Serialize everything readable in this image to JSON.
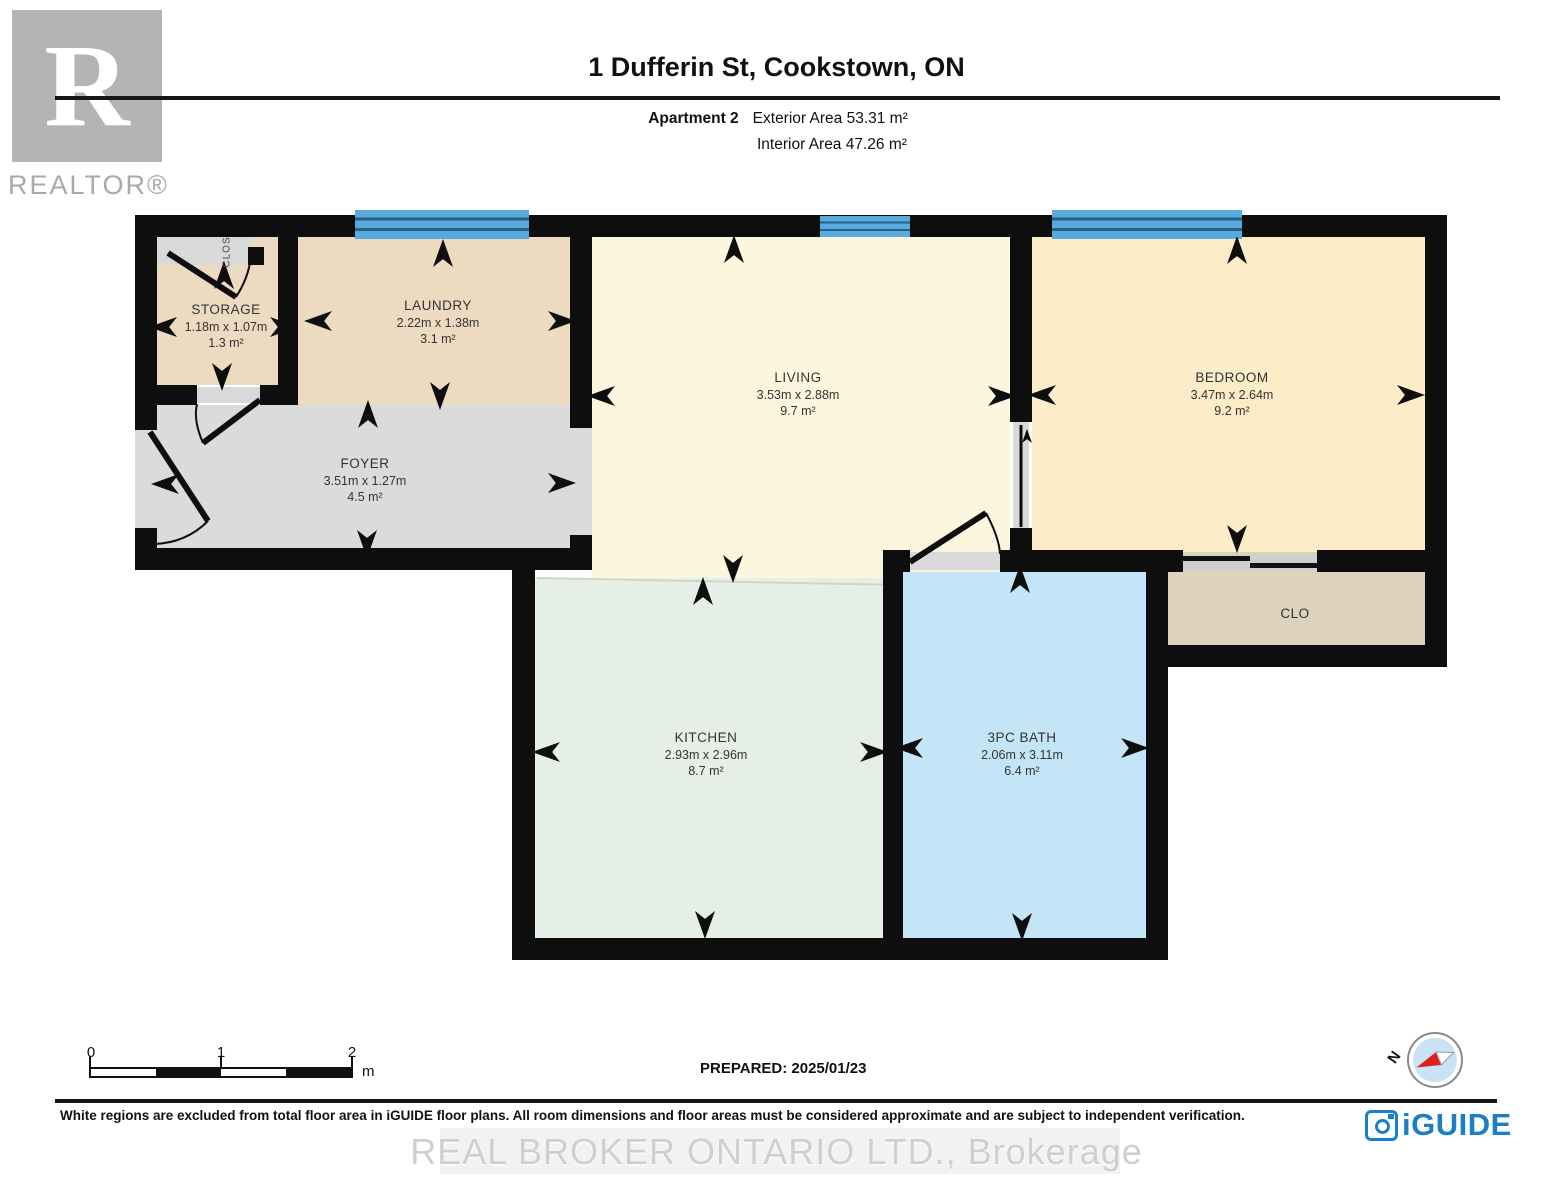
{
  "header": {
    "title": "1 Dufferin St, Cookstown, ON",
    "apartment": "Apartment 2",
    "exterior": "Exterior Area 53.31 m²",
    "interior": "Interior Area 47.26 m²"
  },
  "branding": {
    "realtor_letter": "R",
    "realtor_word": "REALTOR®",
    "iguide": "iGUIDE",
    "compass_north": "N"
  },
  "rooms": [
    {
      "name": "STORAGE",
      "dim": "1.18m x 1.07m",
      "area": "1.3 m²"
    },
    {
      "name": "LAUNDRY",
      "dim": "2.22m x 1.38m",
      "area": "3.1 m²"
    },
    {
      "name": "FOYER",
      "dim": "3.51m x 1.27m",
      "area": "4.5 m²"
    },
    {
      "name": "LIVING",
      "dim": "3.53m x 2.88m",
      "area": "9.7 m²"
    },
    {
      "name": "BEDROOM",
      "dim": "3.47m x 2.64m",
      "area": "9.2 m²"
    },
    {
      "name": "KITCHEN",
      "dim": "2.93m x 2.96m",
      "area": "8.7 m²"
    },
    {
      "name": "3PC BATH",
      "dim": "2.06m x 3.11m",
      "area": "6.4 m²"
    }
  ],
  "closets": {
    "small": "CLOS",
    "bedroom": "CLO"
  },
  "footer": {
    "scale_ticks": [
      "0",
      "1",
      "2"
    ],
    "scale_unit": "m",
    "prepared": "PREPARED: 2025/01/23",
    "disclaimer": "White regions are excluded from total floor area in iGUIDE floor plans. All room dimensions and floor areas must be considered approximate and are subject to independent verification.",
    "watermark": "REAL BROKER ONTARIO LTD., Brokerage"
  },
  "colors": {
    "wall": "#0e0e0e",
    "window_blue": "#57aadb",
    "storage_laundry_fill": "#ecdbc1",
    "foyer_fill": "#dbdbdb",
    "living_fill": "#fdf6df",
    "bedroom_fill": "#fcecc7",
    "kitchen_fill": "#e6efe6",
    "bath_fill": "#c4e5f8",
    "closet_fill": "#ddd2bd",
    "iguide_blue": "#1b7fc3",
    "compass_red": "#e02020"
  }
}
